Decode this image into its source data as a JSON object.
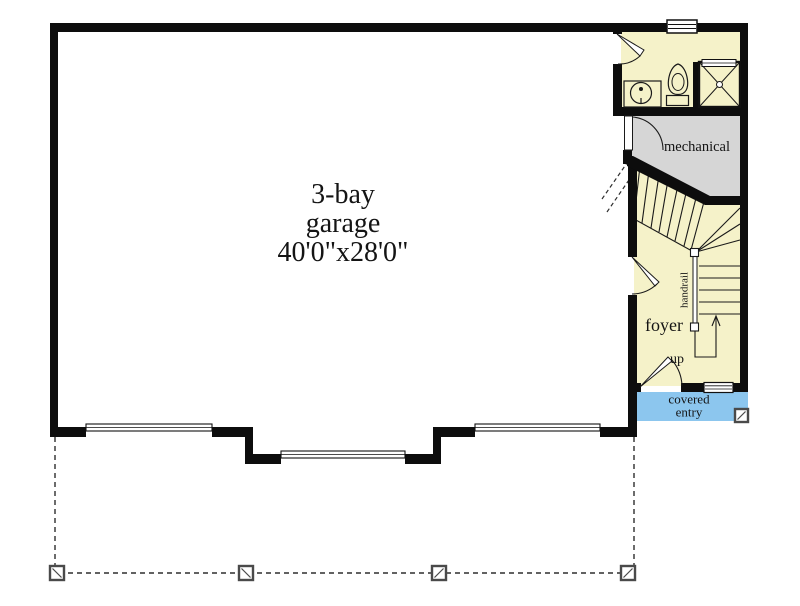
{
  "floor_plan": {
    "garage": {
      "line1": "3-bay",
      "line2": "garage",
      "line3": "40'0\"x28'0\""
    },
    "rooms": {
      "mechanical": "mechanical",
      "foyer": "foyer",
      "covered_entry_line1": "covered",
      "covered_entry_line2": "entry"
    },
    "stairs": {
      "handrail": "handrail",
      "up": "up"
    },
    "colors": {
      "wall": "#0d0d0d",
      "room_fill": "#f5f2c9",
      "mechanical_fill": "#d6d6d6",
      "covered_entry_fill": "#8cc6ee",
      "background": "#ffffff",
      "line": "#1a1a1a"
    },
    "icons": {
      "sink": "sink-icon",
      "toilet": "toilet-icon",
      "shower": "shower-icon",
      "window": "window-icon",
      "garage_door": "garage-door-symbol",
      "door_swing": "door-swing-icon",
      "up_arrow": "up-arrow-icon",
      "porch_post": "porch-post-icon"
    }
  }
}
